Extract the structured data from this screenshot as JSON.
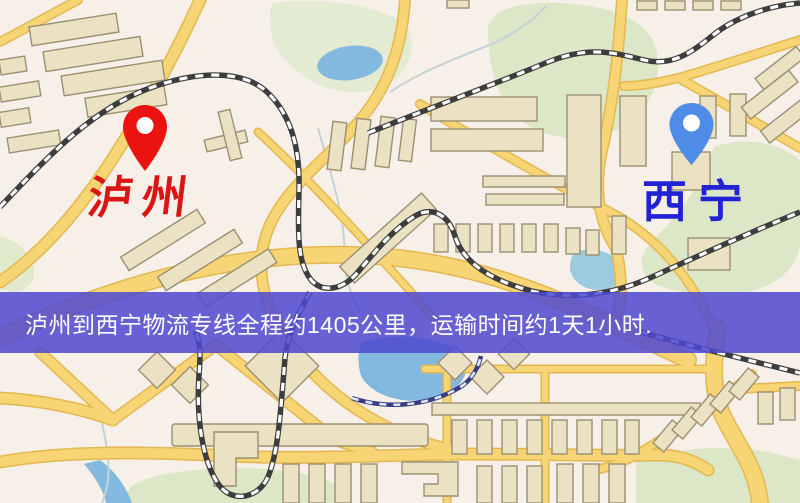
{
  "map": {
    "origin_marker": {
      "label": "泸州",
      "pin_color": "#ea1310",
      "label_color": "#dd1414"
    },
    "destination_marker": {
      "label": "西宁",
      "pin_color": "#4f8ce8",
      "label_color": "#2323d6"
    },
    "info_banner": {
      "text": "泸州到西宁物流专线全程约1405公里，运输时间约1天1小时.",
      "background": "#4d48d0",
      "text_color": "#ffffff"
    },
    "route": {
      "origin": "泸州",
      "destination": "西宁",
      "distance_text": "全程约1405公里",
      "duration_text": "运输时间约1天1小时"
    },
    "colors": {
      "map_background": "#f6f0e8",
      "road_fill": "#f7d474",
      "road_casing": "#e3b851",
      "building_fill": "#ebe2c3",
      "building_stroke": "#9c8f73",
      "park": "#dce7c8",
      "water": "#83b9de",
      "railway": "#3d3d3d"
    }
  }
}
